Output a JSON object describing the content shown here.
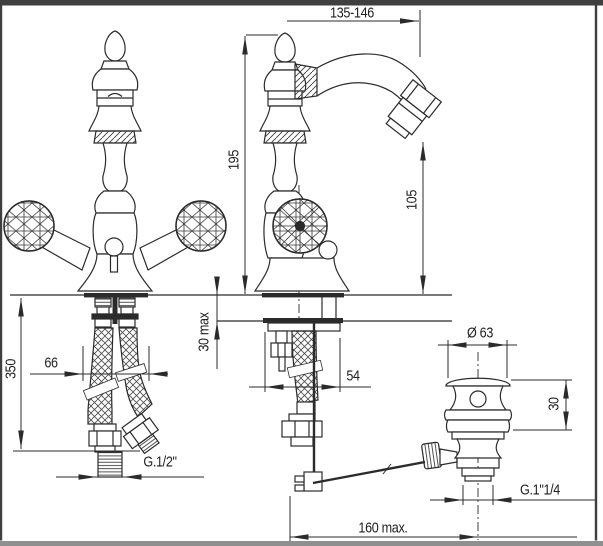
{
  "frame": {
    "border_color": "#3f3f3f",
    "footer_color": "#8f8f8f",
    "background": "#ffffff",
    "line_color": "#2b2b2b"
  },
  "dimensions": {
    "spout_reach": "135-146",
    "total_height": "195",
    "spout_outlet_height": "105",
    "supply_hose_length": "350",
    "hose_spacing": "66",
    "max_deck_thickness": "30 max",
    "body_depth": "54",
    "waste_flange_diameter": "Ø 63",
    "waste_flange_height": "30",
    "supply_thread": "G.1/2\"",
    "waste_thread": "G.1\"1/4",
    "rod_reach": "160 max."
  }
}
